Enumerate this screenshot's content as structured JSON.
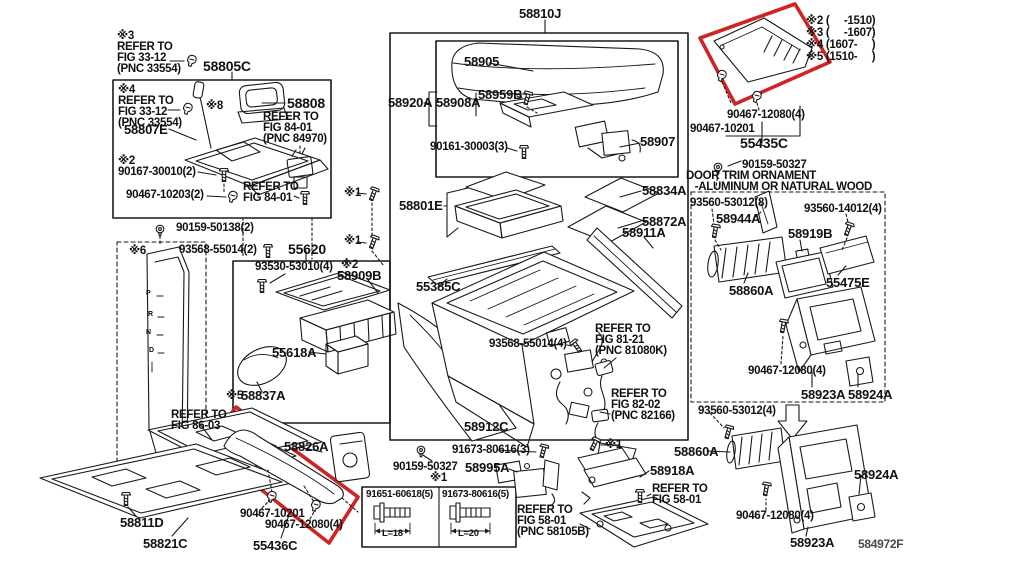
{
  "figure": {
    "code": "584972F"
  },
  "colors": {
    "line": "#191919",
    "highlight_red": "#cf2424",
    "text": "#111111",
    "muted": "#4a4a4a",
    "background": "#ffffff"
  },
  "bolt_table": {
    "note": "※1",
    "columns": [
      {
        "part": "91651-60618(5)",
        "length": "L=18"
      },
      {
        "part": "91673-80616(5)",
        "length": "L=20"
      }
    ]
  },
  "labels": [
    {
      "t": "※3\nREFER TO\nFIG 33-12\n(PNC 33554)",
      "x": 117,
      "y": 31
    },
    {
      "t": "58805C",
      "x": 203,
      "y": 60,
      "fs": 14
    },
    {
      "t": "※4\nREFER TO\nFIG 33-12\n(PNC 33554)",
      "x": 118,
      "y": 85
    },
    {
      "t": "※8",
      "x": 206,
      "y": 101
    },
    {
      "t": "58807E",
      "x": 124,
      "y": 124,
      "fs": 13
    },
    {
      "t": "58808",
      "x": 287,
      "y": 97,
      "fs": 14
    },
    {
      "t": "REFER TO\nFIG 84-01\n(PNC 84970)",
      "x": 263,
      "y": 112
    },
    {
      "t": "※2\n90167-30010(2)",
      "x": 118,
      "y": 156
    },
    {
      "t": "90467-10203(2)",
      "x": 126,
      "y": 190
    },
    {
      "t": "REFER TO\nFIG 84-01",
      "x": 243,
      "y": 182
    },
    {
      "t": "90159-50138(2)",
      "x": 176,
      "y": 223
    },
    {
      "t": "93568-55014(2)",
      "x": 179,
      "y": 245
    },
    {
      "t": "55620",
      "x": 288,
      "y": 243,
      "fs": 14
    },
    {
      "t": "※6",
      "x": 129,
      "y": 246
    },
    {
      "t": "93530-53010(4)",
      "x": 255,
      "y": 262
    },
    {
      "t": "※2",
      "x": 341,
      "y": 260
    },
    {
      "t": "58909B",
      "x": 337,
      "y": 270,
      "fs": 13
    },
    {
      "t": "55618A",
      "x": 272,
      "y": 347,
      "fs": 13
    },
    {
      "t": "※5",
      "x": 226,
      "y": 391
    },
    {
      "t": "58837A",
      "x": 241,
      "y": 390,
      "fs": 13
    },
    {
      "t": "REFER TO\nFIG 86-03",
      "x": 171,
      "y": 410
    },
    {
      "t": "58811D",
      "x": 120,
      "y": 517,
      "fs": 13
    },
    {
      "t": "58821C",
      "x": 143,
      "y": 538,
      "fs": 13
    },
    {
      "t": "58826A",
      "x": 284,
      "y": 441,
      "fs": 13
    },
    {
      "t": "90467-10201",
      "x": 240,
      "y": 509
    },
    {
      "t": "90467-12080(4)",
      "x": 265,
      "y": 520
    },
    {
      "t": "55436C",
      "x": 253,
      "y": 540,
      "fs": 13
    },
    {
      "t": "P",
      "x": 146,
      "y": 291,
      "fs": 7
    },
    {
      "t": "R",
      "x": 148,
      "y": 312,
      "fs": 7
    },
    {
      "t": "N",
      "x": 146,
      "y": 330,
      "fs": 7
    },
    {
      "t": "D",
      "x": 149,
      "y": 348,
      "fs": 7
    },
    {
      "t": "58810J",
      "x": 519,
      "y": 8,
      "fs": 13
    },
    {
      "t": "58905",
      "x": 464,
      "y": 56,
      "fs": 13
    },
    {
      "t": "58920A",
      "x": 388,
      "y": 97,
      "fs": 13
    },
    {
      "t": "58908A",
      "x": 436,
      "y": 97,
      "fs": 13
    },
    {
      "t": "58959B",
      "x": 478,
      "y": 89,
      "fs": 13
    },
    {
      "t": "90161-30003(3)",
      "x": 430,
      "y": 142
    },
    {
      "t": "58907",
      "x": 640,
      "y": 136,
      "fs": 13
    },
    {
      "t": "※1",
      "x": 344,
      "y": 188
    },
    {
      "t": "※1",
      "x": 344,
      "y": 236
    },
    {
      "t": "58801E",
      "x": 399,
      "y": 200,
      "fs": 13
    },
    {
      "t": "58834A",
      "x": 642,
      "y": 185,
      "fs": 13
    },
    {
      "t": "58872A",
      "x": 642,
      "y": 216,
      "fs": 13
    },
    {
      "t": "58911A",
      "x": 622,
      "y": 227,
      "fs": 13
    },
    {
      "t": "55385C",
      "x": 416,
      "y": 281,
      "fs": 13
    },
    {
      "t": "93568-55014(4)",
      "x": 489,
      "y": 339
    },
    {
      "t": "REFER TO\nFIG 81-21\n(PNC 81080K)",
      "x": 595,
      "y": 324
    },
    {
      "t": "REFER TO\nFIG 82-02\n(PNC 82166)",
      "x": 611,
      "y": 389
    },
    {
      "t": "58912C",
      "x": 464,
      "y": 421,
      "fs": 13
    },
    {
      "t": "91673-80616(3)",
      "x": 452,
      "y": 445
    },
    {
      "t": "90159-50327",
      "x": 393,
      "y": 462
    },
    {
      "t": "58995A",
      "x": 465,
      "y": 462,
      "fs": 13
    },
    {
      "t": "REFER TO\nFIG 58-01\n(PNC 58105B)",
      "x": 517,
      "y": 505
    },
    {
      "t": "※1",
      "x": 605,
      "y": 440
    },
    {
      "t": "58918A",
      "x": 650,
      "y": 465,
      "fs": 13
    },
    {
      "t": "REFER TO\nFIG 58-01",
      "x": 652,
      "y": 484
    },
    {
      "t": "※2 (     -1510)",
      "x": 806,
      "y": 16
    },
    {
      "t": "※3 (     -1607)",
      "x": 806,
      "y": 28
    },
    {
      "t": "※4 (1607-     )",
      "x": 806,
      "y": 40
    },
    {
      "t": "※5 (1510-     )",
      "x": 806,
      "y": 52
    },
    {
      "t": "90467-12080(4)",
      "x": 727,
      "y": 110
    },
    {
      "t": "90467-10201",
      "x": 690,
      "y": 124
    },
    {
      "t": "55435C",
      "x": 740,
      "y": 137,
      "fs": 14
    },
    {
      "t": "90159-50327",
      "x": 742,
      "y": 160
    },
    {
      "t": "DOOR TRIM ORNAMENT\n   -ALUMINUM OR NATURAL WOOD",
      "x": 686,
      "y": 171
    },
    {
      "t": "93560-53012(8)",
      "x": 690,
      "y": 198
    },
    {
      "t": "58944A",
      "x": 716,
      "y": 213,
      "fs": 13
    },
    {
      "t": "93560-14012(4)",
      "x": 804,
      "y": 204
    },
    {
      "t": "58919B",
      "x": 788,
      "y": 228,
      "fs": 13
    },
    {
      "t": "58860A",
      "x": 729,
      "y": 285,
      "fs": 13
    },
    {
      "t": "55475E",
      "x": 826,
      "y": 277,
      "fs": 13
    },
    {
      "t": "90467-12080(4)",
      "x": 748,
      "y": 366
    },
    {
      "t": "58923A",
      "x": 801,
      "y": 389,
      "fs": 13
    },
    {
      "t": "58924A",
      "x": 848,
      "y": 389,
      "fs": 13
    },
    {
      "t": "93560-53012(4)",
      "x": 698,
      "y": 406
    },
    {
      "t": "58860A",
      "x": 674,
      "y": 446,
      "fs": 13
    },
    {
      "t": "58924A",
      "x": 854,
      "y": 469,
      "fs": 13
    },
    {
      "t": "90467-12080(4)",
      "x": 736,
      "y": 511
    },
    {
      "t": "58923A",
      "x": 790,
      "y": 537,
      "fs": 13
    }
  ]
}
